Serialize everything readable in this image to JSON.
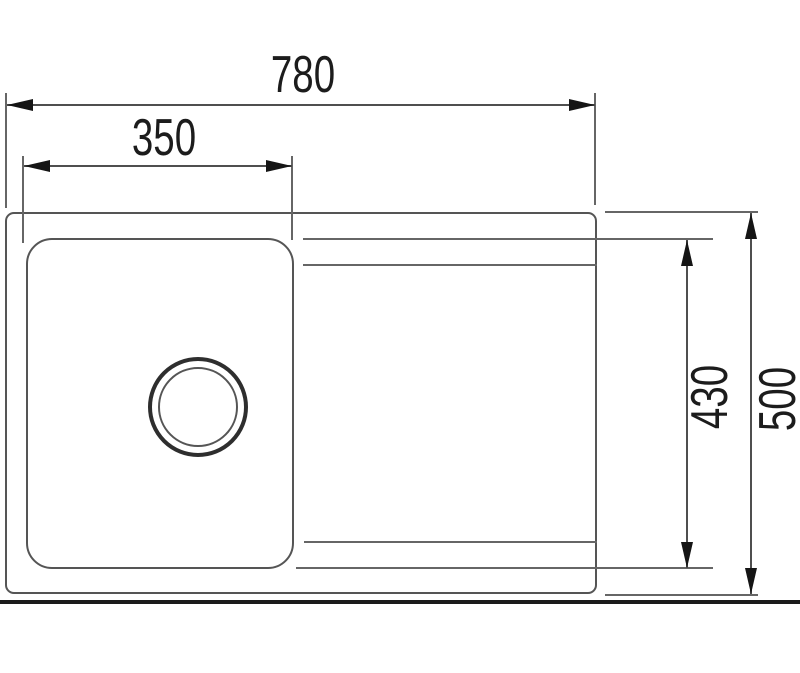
{
  "drawing": {
    "view": "sink-top-view-dimension-drawing",
    "dimensions": {
      "overall_width": {
        "value": "780"
      },
      "bowl_width": {
        "value": "350"
      },
      "drainer_inner_depth": {
        "value": "430"
      },
      "overall_depth": {
        "value": "500"
      }
    },
    "colors": {
      "background": "#ffffff",
      "outline": "#555555",
      "groove": "#666666",
      "arrow": "#151515",
      "dimension_text": "#1c1c1c",
      "baseline": "#1b1b1b"
    }
  }
}
